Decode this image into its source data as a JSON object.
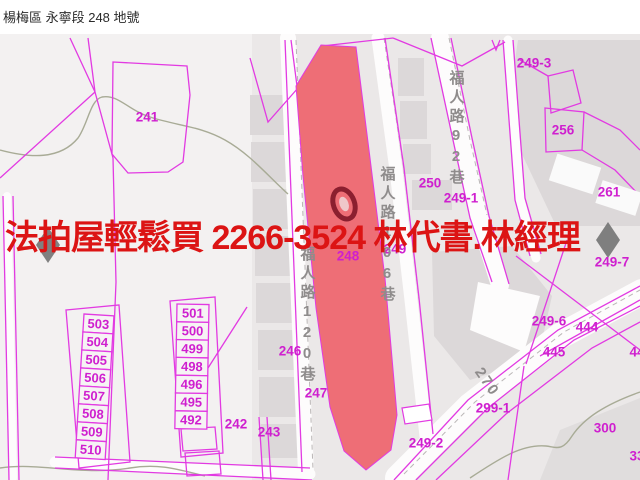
{
  "header": {
    "title": "楊梅區 永寧段 248 地號"
  },
  "overlay": {
    "ad_text": "法拍屋輕鬆買  2266-3524  林代書.林經理"
  },
  "map": {
    "highlighted_parcel": "248",
    "parcel_labels": [
      {
        "text": "241",
        "x": 147,
        "y": 117
      },
      {
        "text": "242",
        "x": 236,
        "y": 424
      },
      {
        "text": "243",
        "x": 269,
        "y": 432
      },
      {
        "text": "246",
        "x": 290,
        "y": 351
      },
      {
        "text": "247",
        "x": 316,
        "y": 393
      },
      {
        "text": "248",
        "x": 348,
        "y": 256
      },
      {
        "text": "249",
        "x": 395,
        "y": 249
      },
      {
        "text": "250",
        "x": 430,
        "y": 183
      },
      {
        "text": "249-1",
        "x": 461,
        "y": 198
      },
      {
        "text": "249-3",
        "x": 534,
        "y": 63
      },
      {
        "text": "256",
        "x": 563,
        "y": 130
      },
      {
        "text": "261",
        "x": 609,
        "y": 192
      },
      {
        "text": "249-7",
        "x": 612,
        "y": 262
      },
      {
        "text": "249-6",
        "x": 549,
        "y": 321
      },
      {
        "text": "444",
        "x": 587,
        "y": 327
      },
      {
        "text": "445",
        "x": 554,
        "y": 352
      },
      {
        "text": "44",
        "x": 637,
        "y": 352
      },
      {
        "text": "299-1",
        "x": 493,
        "y": 408
      },
      {
        "text": "249-2",
        "x": 426,
        "y": 443
      },
      {
        "text": "300",
        "x": 605,
        "y": 428
      },
      {
        "text": "33",
        "x": 637,
        "y": 456
      }
    ],
    "road_labels": [
      {
        "text": "福人路120巷",
        "x": 307,
        "y": 246,
        "orientation": "vertical"
      },
      {
        "text": "福人路106巷",
        "x": 387,
        "y": 166,
        "orientation": "vertical"
      },
      {
        "text": "福人路92巷",
        "x": 456,
        "y": 70,
        "orientation": "vertical"
      },
      {
        "text": "270",
        "x": 487,
        "y": 382,
        "orientation": "rotated"
      }
    ],
    "unit_columns": [
      {
        "name": "left",
        "x": 84,
        "y": 314,
        "w": 30,
        "h": 18,
        "tilt": 3.5,
        "units": [
          "503",
          "504",
          "505",
          "506",
          "507",
          "508",
          "509",
          "510"
        ]
      },
      {
        "name": "right",
        "x": 177,
        "y": 304,
        "w": 32,
        "h": 17.8,
        "tilt": 1,
        "units": [
          "501",
          "500",
          "499",
          "498",
          "496",
          "495",
          "492"
        ]
      }
    ],
    "nav_arrows": {
      "left": "pan-left",
      "right": "pan-right"
    },
    "colors": {
      "magenta-line": "#e23ae2",
      "magenta-label": "#cf1fcf",
      "road-label-gray": "#8f8c8c",
      "highlight-fill": "#ee6e76",
      "marker-red": "#8b1f2f",
      "ad-red": "#dc1414",
      "map-bg": "#ebe8e8"
    }
  }
}
